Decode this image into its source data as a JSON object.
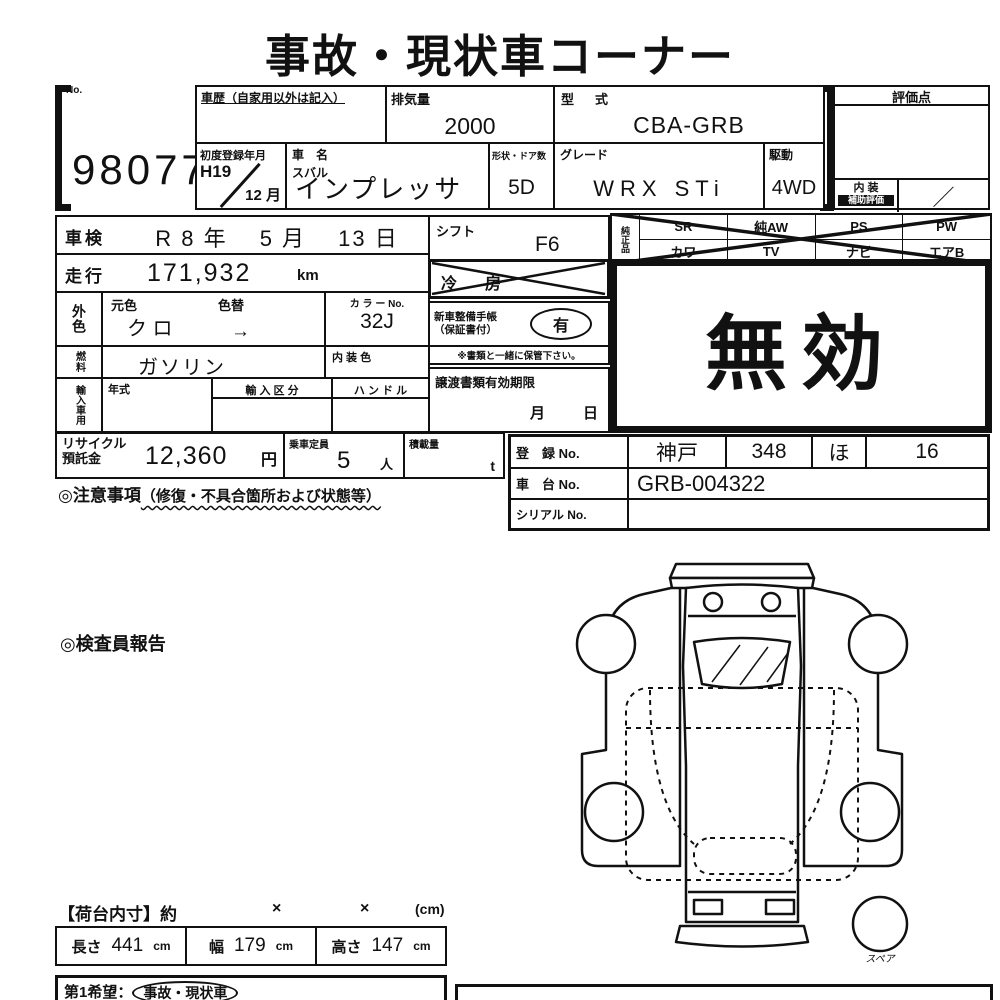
{
  "page": {
    "bg": "#ffffff",
    "ink": "#111111"
  },
  "title": "事故・現状車コーナー",
  "lot": {
    "no_label": "No.",
    "number": "98077"
  },
  "head": {
    "history_label": "車歴（自家用以外は記入）",
    "displacement_label": "排気量",
    "displacement": "2000",
    "model_code_label": "型　式",
    "model_code": "CBA-GRB",
    "first_reg_label": "初度登録年月",
    "first_reg_top": "H19",
    "first_reg_bottom": "12 月",
    "name_label": "車　名",
    "maker": "スバル",
    "name": "インプレッサ",
    "shape_label": "形状・ドア数",
    "shape": "5D",
    "grade_label": "グレード",
    "grade": "WRX STi",
    "drive_label": "駆動",
    "drive": "4WD",
    "score_label": "評価点",
    "interior_label1": "内 装",
    "interior_label2": "補助評価",
    "interior_value": "／"
  },
  "spec": {
    "shaken_label": "車検",
    "shaken": "R 8 年　 5 月　 13 日",
    "mileage_label": "走行",
    "mileage": "171,932",
    "mileage_unit": "km",
    "ext_color_label": "外色",
    "orig_color_label": "元色",
    "repaint_label": "色替",
    "orig_color": "ク ロ",
    "repaint_arrow": "→",
    "color_no_label": "カ ラ ー No.",
    "color_no": "32J",
    "fuel_label": "燃料",
    "fuel": "ガソリン",
    "int_color_label": "内 装 色",
    "import_label": "輸入車用",
    "import_year_label": "年式",
    "import_class_label": "輸 入 区 分",
    "handle_label": "ハ ン ド ル",
    "shift_label": "シフト",
    "shift": "F6",
    "aircon_label": "冷　房",
    "book_label1": "新車整備手帳",
    "book_label2": "（保証書付）",
    "book_value": "有",
    "book_note": "※書類と一緒に保管下さい。",
    "transfer_label": "譲渡書類有効期限",
    "transfer_month": "月",
    "transfer_day": "日"
  },
  "equipment": {
    "label": "純正品",
    "row1": [
      "SR",
      "純AW",
      "PS",
      "PW"
    ],
    "row2": [
      "カワ",
      "TV",
      "ナビ",
      "エアB"
    ]
  },
  "void_stamp": "無効",
  "reg": {
    "recycle_label1": "リサイクル",
    "recycle_label2": "預託金",
    "recycle_value": "12,360",
    "recycle_unit": "円",
    "capacity_label": "乗車定員",
    "capacity_value": "5",
    "capacity_unit": "人",
    "load_label": "積載量",
    "load_unit": "t",
    "notes_prefix": "◎注意事項",
    "notes_paren": "（修復・不具合箇所および状態等）",
    "reg_no_label": "登　録 No.",
    "reg_area": "神戸",
    "reg_class": "348",
    "reg_kana": "ほ",
    "reg_number": "16",
    "chassis_label": "車　台 No.",
    "chassis": "GRB-004322",
    "serial_label": "シリアル No."
  },
  "inspection": {
    "report_label": "◎検査員報告",
    "spare_label": "スペア"
  },
  "cargo": {
    "header_label": "【荷台内寸】約",
    "x1": "×",
    "x2": "×",
    "unit": "(cm)",
    "length_label": "長さ",
    "length": "441",
    "length_unit": "cm",
    "width_label": "幅",
    "width": "179",
    "width_unit": "cm",
    "height_label": "高さ",
    "height": "147",
    "height_unit": "cm"
  },
  "footer": {
    "wish_label": "第1希望：",
    "wish_value": "事故・現状車"
  }
}
